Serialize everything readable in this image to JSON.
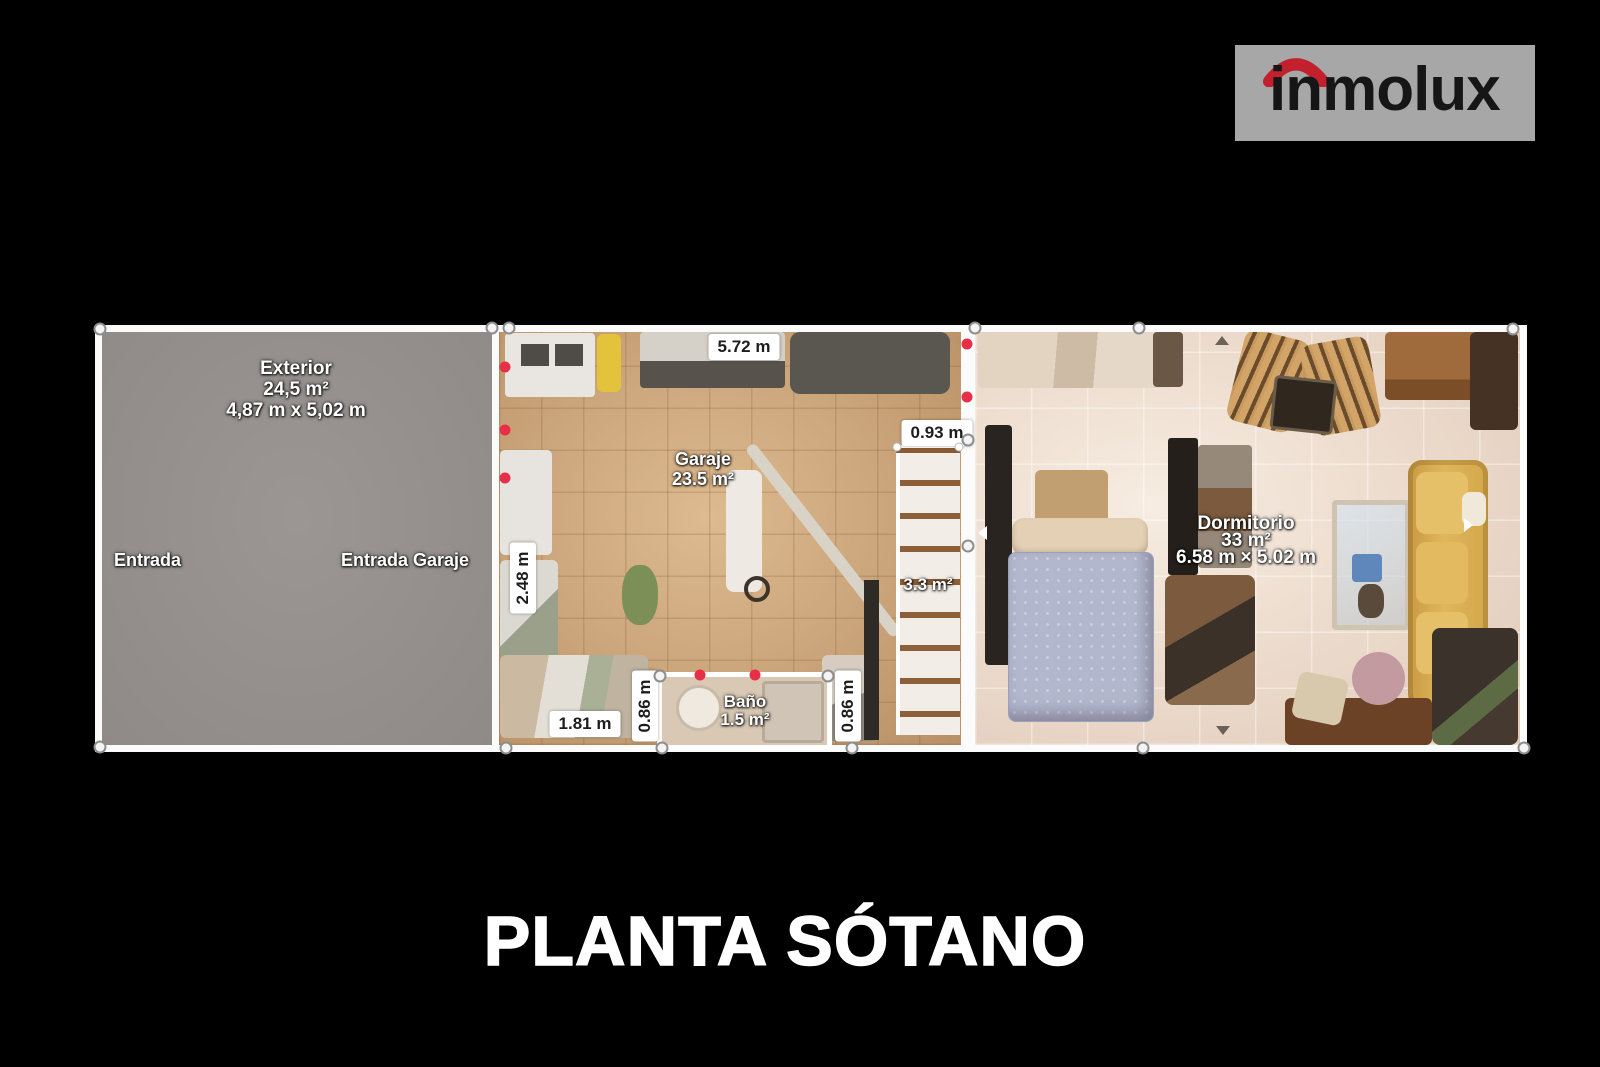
{
  "logo": {
    "text": "inmolux"
  },
  "title": "PLANTA SÓTANO",
  "rooms": {
    "exterior": {
      "name": "Exterior",
      "area": "24,5 m²",
      "dimensions": "4,87 m x 5,02 m"
    },
    "entrances": {
      "left": "Entrada",
      "right": "Entrada Garaje"
    },
    "garaje": {
      "name": "Garaje",
      "area": "23.5 m²"
    },
    "stairs": {
      "area": "3.3 m²"
    },
    "bano": {
      "name": "Baño",
      "area": "1.5 m²"
    },
    "dormitorio": {
      "name": "Dormitorio",
      "area": "33 m²",
      "dimensions": "6.58 m × 5.02 m"
    }
  },
  "measurements": {
    "garaje_top_width": "5.72 m",
    "stairs_opening": "0.93 m",
    "garaje_left_depth": "2.48 m",
    "garaje_bottom_segment": "1.81 m",
    "bano_left_height": "0.86 m",
    "bano_right_height": "0.86 m"
  },
  "colors": {
    "background": "#000000",
    "logo_bg": "#a7a7a7",
    "accent_red": "#c1202c",
    "plan_border": "#fbfbfb",
    "exterior_fill": "#96918f"
  }
}
